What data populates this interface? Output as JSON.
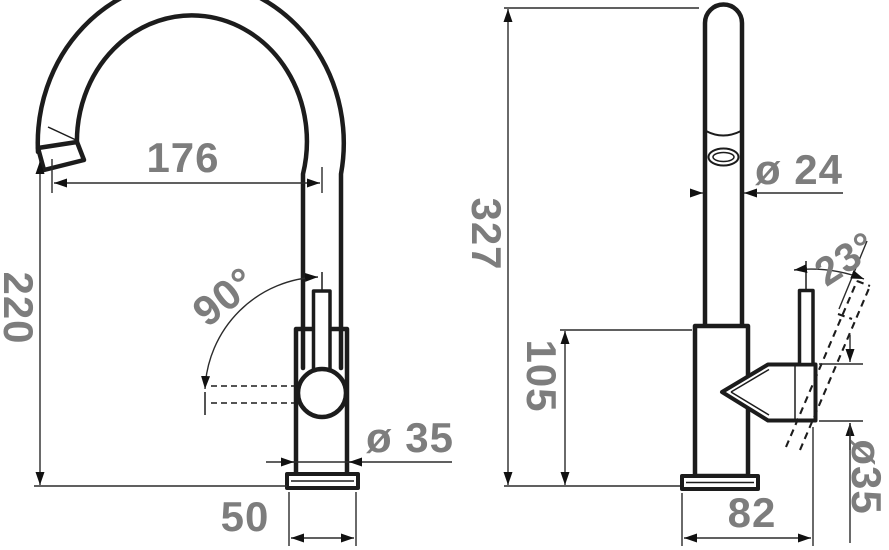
{
  "drawing": {
    "type": "technical-dimension-drawing",
    "subject": "Kitchen faucet, front view and side view with dimensions (mm)",
    "colors": {
      "outline": "#1c1c1c",
      "dimension_lines": "#2b2b2b",
      "dimension_text": "#7d7d7d",
      "background": "#ffffff"
    },
    "views": {
      "front": {
        "name": "front view",
        "dimensions": {
          "spout_reach": "176",
          "spout_height": "220",
          "handle_swing_angle": "90°",
          "body_diameter": "ø 35",
          "base_width": "50"
        }
      },
      "side": {
        "name": "side view",
        "dimensions": {
          "overall_height": "327",
          "body_height": "105",
          "spout_tube_diameter": "ø 24",
          "handle_tilt_angle": "23°",
          "handle_housing_diameter": "ø35",
          "base_depth": "82"
        }
      }
    }
  }
}
